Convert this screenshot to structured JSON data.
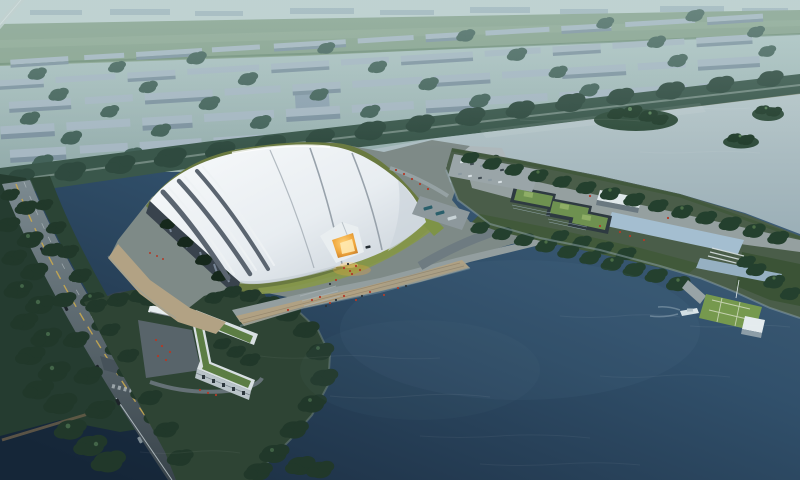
{
  "scene": {
    "type": "aerial-architectural-rendering",
    "time_of_day": "dusk",
    "counts": {
      "buses": 3,
      "road_cars": 5,
      "parked_cars": 16,
      "tree_islands": 3,
      "boats": 1
    },
    "colors": {
      "haze_top": "#b7cccb",
      "haze_bottom": "#93acab",
      "far_strip": "#c0d2d1",
      "far_block": "#9fb3bd",
      "field_green": "#87a28c",
      "field_light": "#93ad97",
      "city_block_top": "#a7b8c3",
      "city_block_front": "#7e93a0",
      "bg_tree": "#44635a",
      "belt_green": "#3a574b",
      "belt_tree": "#2f4a3f",
      "shore_sand": "#a39f85",
      "water_light_top": "#b6c6c9",
      "water_light_bottom": "#9bafb7",
      "lake_top": "#4a677f",
      "lake_mid": "#31506b",
      "lake_deep": "#1b2d41",
      "island_green": "#2f4c3b",
      "roadside_green": "#253c30",
      "verge_green": "#2b4435",
      "tree_dark": "#21382a",
      "tree_highlight": "#4c7150",
      "road_top": "#7c8a90",
      "road_bottom": "#39444b",
      "lane_yellow": "#c8a850",
      "lane_white": "#cdd5d8",
      "platform_gray": "#7e8a87",
      "promenade_gray": "#939e9f",
      "beach_sand": "#b2a284",
      "boardwalk_wood": "#b0a183",
      "lawn_dark": "#6a7a40",
      "lawn_bright": "#87984b",
      "roof_white": "#f8fafb",
      "roof_shade": "#c4cdd5",
      "roof_groove": "#5b6570",
      "facade_dark": "#39434d",
      "glow_core": "#ffd27a",
      "glow_mid": "#f0a83e",
      "glow_deep": "#b5691f",
      "quay_light": "#aeb8bb",
      "pool_blue": "#a4bed0",
      "green_roof": "#6e9150",
      "dark_building": "#2e3a41",
      "pier_lawn": "#76994e",
      "hut_white": "#e4ebee",
      "boat_white": "#dce6ea",
      "parcel_lawn": "#2e4434",
      "lbuilding_white": "#d8dfe2",
      "lbuilding_roof": "#5c7d44",
      "plaza_gray": "#58646a",
      "people_red": "#b23a28",
      "people_dark": "#2c3338",
      "car_dark": "#1d2429",
      "bus_teal": "#2a5f6b",
      "reflection_rust": "#6e4f3d",
      "sheen_blue": "#6888a0"
    }
  }
}
